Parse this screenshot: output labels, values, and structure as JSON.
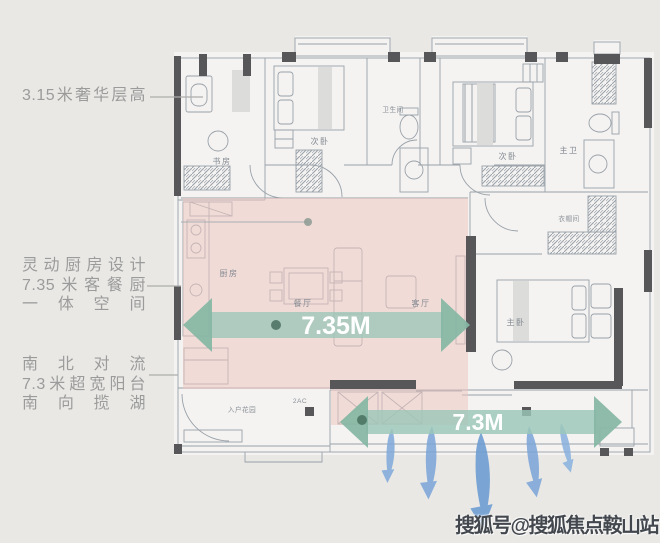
{
  "page": {
    "background": "#e9e8e5"
  },
  "left_annotations": [
    {
      "id": "ceiling-height",
      "lines": [
        "3.15米奢华层高"
      ]
    },
    {
      "id": "kitchen-design",
      "lines": [
        "灵动厨房设计",
        "7.35米客餐厨",
        "一体空间"
      ]
    },
    {
      "id": "balcony-convection",
      "lines": [
        "南北对流",
        "7.3米超宽阳台",
        "南向揽湖"
      ]
    }
  ],
  "floor_plan": {
    "rooms": [
      {
        "label": "书房"
      },
      {
        "label": "次卧"
      },
      {
        "label": "卫生间"
      },
      {
        "label": "次卧"
      },
      {
        "label": "主卫"
      },
      {
        "label": "厨房"
      },
      {
        "label": "餐厅"
      },
      {
        "label": "客厅"
      },
      {
        "label": "衣帽间"
      },
      {
        "label": "主卧"
      },
      {
        "label": "入户花园"
      },
      {
        "label": "2AC"
      }
    ],
    "dimension_arrows": [
      {
        "label": "7.35M",
        "orientation": "horizontal",
        "area": "客餐厨一体空间"
      },
      {
        "label": "7.3M",
        "orientation": "horizontal",
        "area": "超宽阳台"
      }
    ]
  },
  "watermark": "搜狐号@搜狐焦点鞍山站",
  "colors": {
    "highlight_pink": "#eec6c0",
    "arrow_green": "#8fbfae",
    "arrow_green_dark": "#85b7a4",
    "airflow_blue": "#7aa5d8",
    "wall": "#57575a",
    "annotation_text": "#9b9b9b"
  }
}
